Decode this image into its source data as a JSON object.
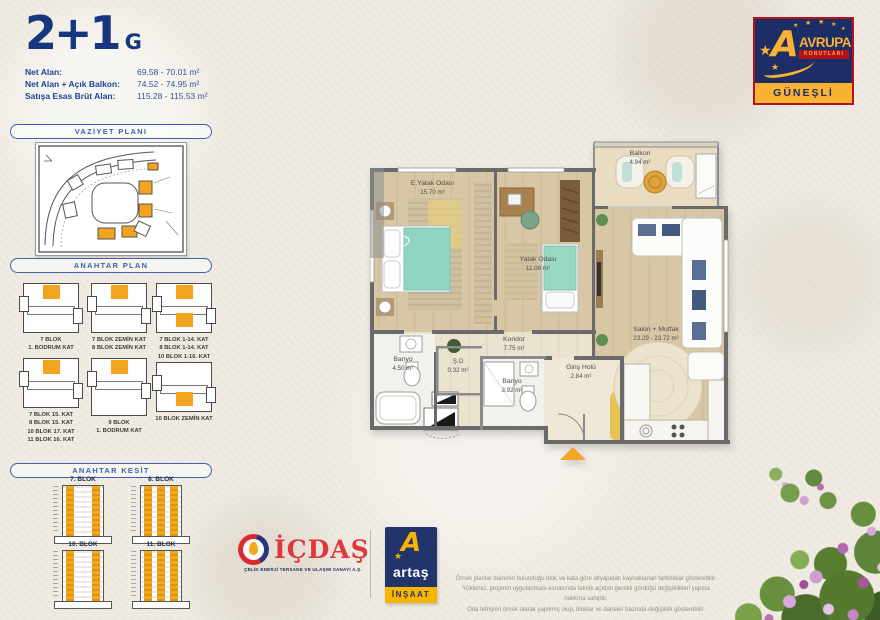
{
  "header": {
    "type": "2+1",
    "variant": "G",
    "specs": [
      {
        "label": "Net Alan:",
        "value": "69.58 - 70.01 m²"
      },
      {
        "label": "Net Alan + Açık Balkon:",
        "value": "74.52 - 74.95 m²"
      },
      {
        "label": "Satışa Esas Brüt Alan:",
        "value": "115.28 - 115.53 m²"
      }
    ]
  },
  "brand": {
    "name": "AVRUPA",
    "subname": "KONUTLARI",
    "location": "GÜNEŞLİ",
    "star_icon": "★",
    "colors": {
      "navy": "#1d2d66",
      "yellow": "#f9b233",
      "red": "#b5121b",
      "accent_orange": "#f2a41f"
    }
  },
  "sidebar": {
    "vaziyet_title": "VAZİYET PLANI",
    "anahtar_plan_title": "ANAHTAR PLAN",
    "anahtar_kesit_title": "ANAHTAR KESİT",
    "key_plans": [
      "7 BLOK\n1. BODRUM KAT",
      "7 BLOK ZEMİN KAT\n8 BLOK ZEMİN KAT",
      "7 BLOK 1-14. KAT\n8 BLOK 1-14. KAT\n10 BLOK 1-16. KAT\n11 BLOK 2-16. KAT",
      "7 BLOK 15. KAT\n8 BLOK 15. KAT\n10 BLOK 17. KAT\n11 BLOK 16. KAT",
      "9 BLOK\n1. BODRUM KAT",
      "10 BLOK ZEMİN KAT"
    ],
    "towers": [
      "7. BLOK",
      "8. BLOK",
      "10. BLOK",
      "11. BLOK"
    ]
  },
  "floorplan": {
    "rooms": [
      {
        "name": "E.Yatak Odası",
        "area": "15.70 m²"
      },
      {
        "name": "Yatak Odası",
        "area": "11.08 m²"
      },
      {
        "name": "Salon + Mutfak",
        "area": "23.29 - 23.72 m²"
      },
      {
        "name": "Balkon",
        "area": "4.94 m²"
      },
      {
        "name": "Koridor",
        "area": "7.75 m²"
      },
      {
        "name": "Banyo",
        "area": "4.50 m²"
      },
      {
        "name": "Ş.O",
        "area": "0.32 m²"
      },
      {
        "name": "Banyo",
        "area": "3.92 m²"
      },
      {
        "name": "Giriş Holü",
        "area": "2.84 m²"
      }
    ]
  },
  "footer": {
    "icdas_name": "İÇDAŞ",
    "icdas_tagline": "ÇELİK ENERJİ TERSANE VE ULAŞIM SANAYİ A.Ş.",
    "artas_name": "artaş",
    "artas_letter": "A",
    "artas_sub": "İNŞAAT",
    "disclaimer": "Örnek planlar dairenin bulunduğu blok ve kata göre altyapıdan kaynaklanan farklılıklar gösterebilir.\nYüklenici, projenin uygulanması esnasında teknik açıdan gerekli gördüğü değişiklikleri yapma hakkına sahiptir.\nOda tefrişleri örnek olarak yapılmış olup, bloklar ve daireler bazında değişiklik gösterebilir."
  }
}
